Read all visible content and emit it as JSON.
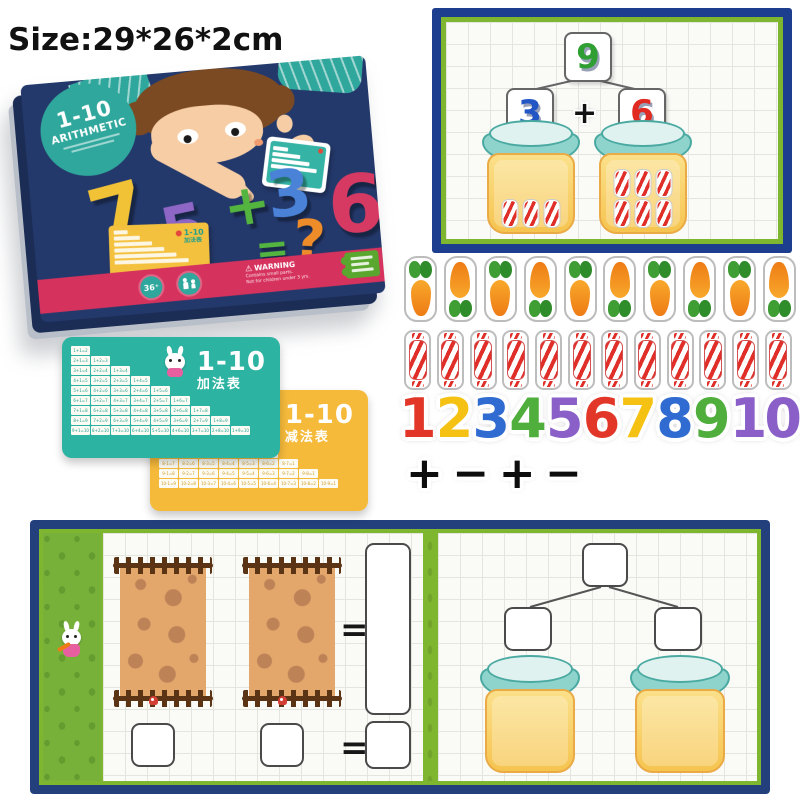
{
  "page": {
    "size_label": "Size:29*26*2cm"
  },
  "palette": {
    "box_navy": "#24396b",
    "board_navy": "#1d3e8f",
    "play_navy": "#24407c",
    "frame_green": "#7fb62f",
    "strip_green": "#77b13a",
    "teal_card": "#2db3a2",
    "yellow_card": "#f6ba3b",
    "pink_band": "#d6325e",
    "badge_teal": "#2fa79c",
    "jar_yellow": "#f6c44f",
    "lid_teal": "#8fd4cc",
    "candy_red": "#df2f28"
  },
  "product_box": {
    "title_line1": "1-10",
    "title_line2": "ARITHMETIC",
    "equation_digits": [
      {
        "ch": "7",
        "color": "#f2c236"
      },
      {
        "ch": "5",
        "color": "#8e66c6"
      },
      {
        "ch": "+",
        "color": "#53b43f"
      },
      {
        "ch": "3",
        "color": "#4a82d7"
      },
      {
        "ch": "6",
        "color": "#d63a63"
      }
    ],
    "equals": "=",
    "question_mark": "?",
    "age_badge": "36⁺",
    "warning_title": "WARNING",
    "warning_line1": "Contains small parts.",
    "warning_line2": "Not for children under 3 yrs.",
    "mini_card_range": "1-10",
    "mini_card_cn": "加法表"
  },
  "bond_board": {
    "top_number": {
      "label": "9",
      "color": "#2f9e33"
    },
    "left_number": {
      "label": "3",
      "color": "#2356c5"
    },
    "right_number": {
      "label": "6",
      "color": "#e02a22"
    },
    "operator": "+",
    "left_jar_candies": 3,
    "right_jar_candies": 6
  },
  "stickers": {
    "carrot_count": 10,
    "candy_count": 12,
    "numbers": [
      {
        "label": "1",
        "color": "#e23728"
      },
      {
        "label": "2",
        "color": "#f5c113"
      },
      {
        "label": "3",
        "color": "#2f6bd0"
      },
      {
        "label": "4",
        "color": "#4fae3c"
      },
      {
        "label": "5",
        "color": "#8a5fc8"
      },
      {
        "label": "6",
        "color": "#e23728"
      },
      {
        "label": "7",
        "color": "#f5c113"
      },
      {
        "label": "8",
        "color": "#2f6bd0"
      },
      {
        "label": "9",
        "color": "#4fae3c"
      },
      {
        "label": "10",
        "color": "#8a5fc8"
      }
    ],
    "operators": [
      "+",
      "−",
      "+",
      "−"
    ]
  },
  "addition_card": {
    "range": "1-10",
    "title_cn": "加法表",
    "mascot": "rabbit",
    "rows": [
      [
        "1+1=2"
      ],
      [
        "2+1=3",
        "1+2=3"
      ],
      [
        "3+1=4",
        "2+2=4",
        "1+3=4"
      ],
      [
        "4+1=5",
        "3+2=5",
        "2+3=5",
        "1+4=5"
      ],
      [
        "5+1=6",
        "4+2=6",
        "3+3=6",
        "2+4=6",
        "1+5=6"
      ],
      [
        "6+1=7",
        "5+2=7",
        "4+3=7",
        "3+4=7",
        "2+5=7",
        "1+6=7"
      ],
      [
        "7+1=8",
        "6+2=8",
        "5+3=8",
        "4+4=8",
        "3+5=8",
        "2+6=8",
        "1+7=8"
      ],
      [
        "8+1=9",
        "7+2=9",
        "6+3=9",
        "5+4=9",
        "4+5=9",
        "3+6=9",
        "2+7=9",
        "1+8=9"
      ],
      [
        "9+1=10",
        "8+2=10",
        "7+3=10",
        "6+4=10",
        "5+5=10",
        "4+6=10",
        "3+7=10",
        "2+8=10",
        "1+9=10"
      ]
    ]
  },
  "subtraction_card": {
    "range": "1-10",
    "title_cn": "减法表",
    "mascot": "panda",
    "rows": [
      [
        "2-1=1"
      ],
      [
        "3-1=2",
        "3-2=1"
      ],
      [
        "4-1=3",
        "4-2=2",
        "4-3=1"
      ],
      [
        "5-1=4",
        "5-2=3",
        "5-3=2",
        "5-4=1"
      ],
      [
        "6-1=5",
        "6-2=4",
        "6-3=3",
        "6-4=2",
        "6-5=1"
      ],
      [
        "7-1=6",
        "7-2=5",
        "7-3=4",
        "7-4=3",
        "7-5=2",
        "7-6=1"
      ],
      [
        "8-1=7",
        "8-2=6",
        "8-3=5",
        "8-4=4",
        "8-5=3",
        "8-6=2",
        "8-7=1"
      ],
      [
        "9-1=8",
        "9-2=7",
        "9-3=6",
        "9-4=5",
        "9-5=4",
        "9-6=3",
        "9-7=2",
        "9-8=1"
      ],
      [
        "10-1=9",
        "10-2=8",
        "10-3=7",
        "10-4=6",
        "10-5=5",
        "10-6=4",
        "10-7=3",
        "10-8=2",
        "10-9=1"
      ]
    ]
  },
  "play_board": {
    "equals_top": "=",
    "equals_bottom": "="
  }
}
